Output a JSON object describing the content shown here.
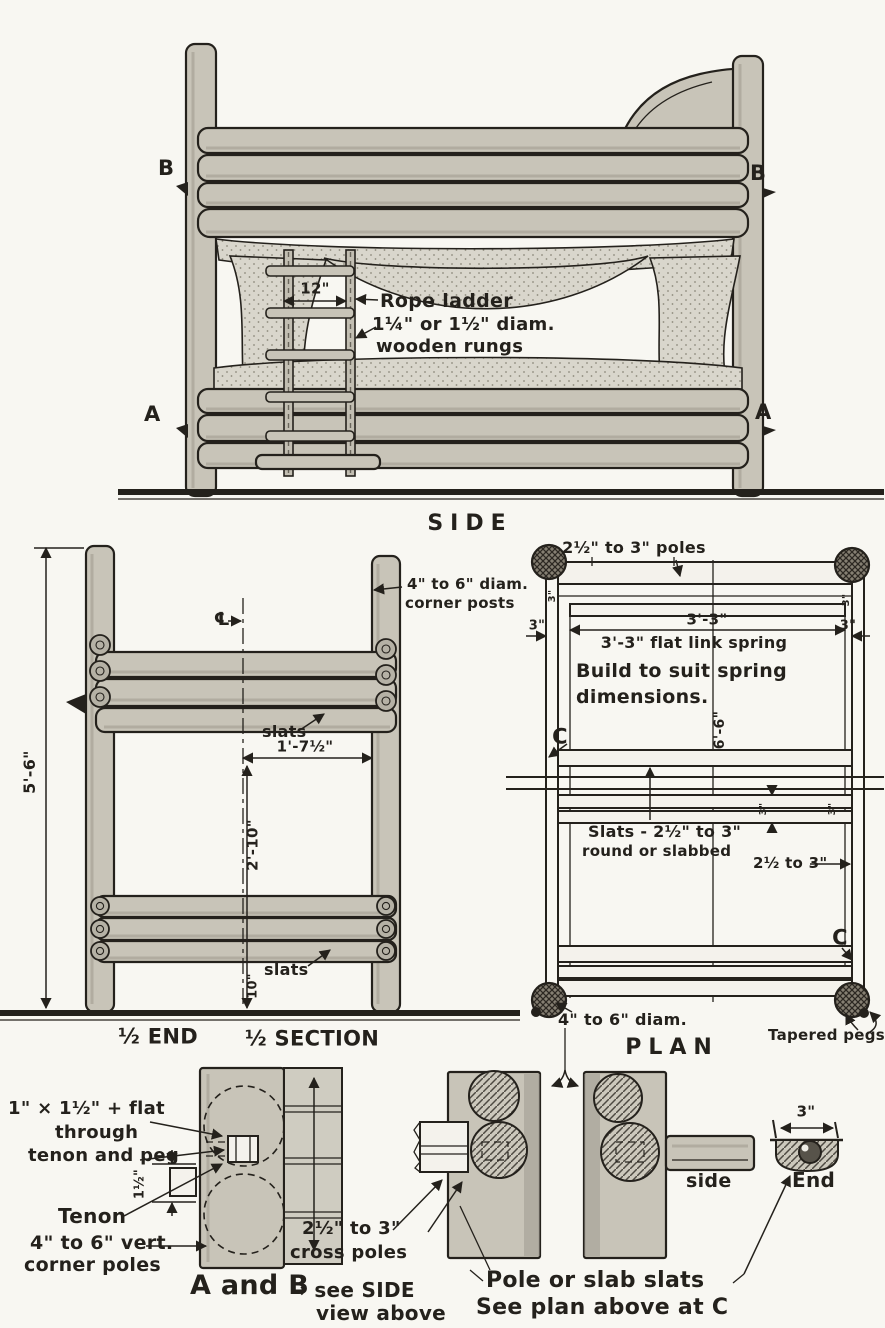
{
  "colors": {
    "ink": "#24211c",
    "wood": "#c8c4b8",
    "paper": "#f8f7f2"
  },
  "side_view": {
    "title": "SIDE",
    "marker_b": "B",
    "marker_a": "A",
    "ladder_width_dim": "12\"",
    "ladder_note1": "Rope ladder",
    "ladder_note2": "1¼\" or 1½\" diam.",
    "ladder_note3": "wooden rungs"
  },
  "end_section": {
    "overall_height_dim": "5'-6\"",
    "corner_post_note1": "4\" to 6\" diam.",
    "corner_post_note2": "corner posts",
    "centerline_symbol": "℄",
    "slats_label": "slats",
    "half_width_dim": "1'-7½\"",
    "bunk_spacing_dim": "2'-10\"",
    "floor_clearance_dim": "10\"",
    "half_end_title": "½ END",
    "half_section_title": "½ SECTION"
  },
  "plan": {
    "title": "PLAN",
    "poles_dim_note": "2½\" to 3\" poles",
    "spring_width_dim": "3'-3\"",
    "spring_note": "3'-3\" flat link spring",
    "build_note1": "Build to suit spring",
    "build_note2": "dimensions.",
    "length_dim": "6'-6\"",
    "small_dim": "3\"",
    "c_marker": "C",
    "slats_note1": "Slats - 2½\" to 3\"",
    "slats_note2": "round or slabbed",
    "slat_size_dim": "2½ to 3\"",
    "post_diam_note": "4\" to 6\" diam.",
    "tapered_pegs_note": "Tapered pegs"
  },
  "details": {
    "tenon_spec1": "1\" × 1½\" + flat",
    "tenon_spec2": "through",
    "tenon_spec3": "tenon and peg",
    "tenon_width_dim": "1½\"",
    "tenon_label": "Tenon",
    "corner_pole_note1": "4\" to 6\" vert.",
    "corner_pole_note2": "corner poles",
    "cross_pole_note1": "2½\" to 3\"",
    "cross_pole_note2": "cross poles",
    "ab_ref_big": "A and B",
    "ab_ref_see": "→ see SIDE",
    "ab_ref_above": "view above",
    "side_label": "side",
    "end_label": "End",
    "end_width_dim": "3\"",
    "slats_ref1": "Pole or slab slats",
    "slats_ref2": "See plan above at C"
  }
}
